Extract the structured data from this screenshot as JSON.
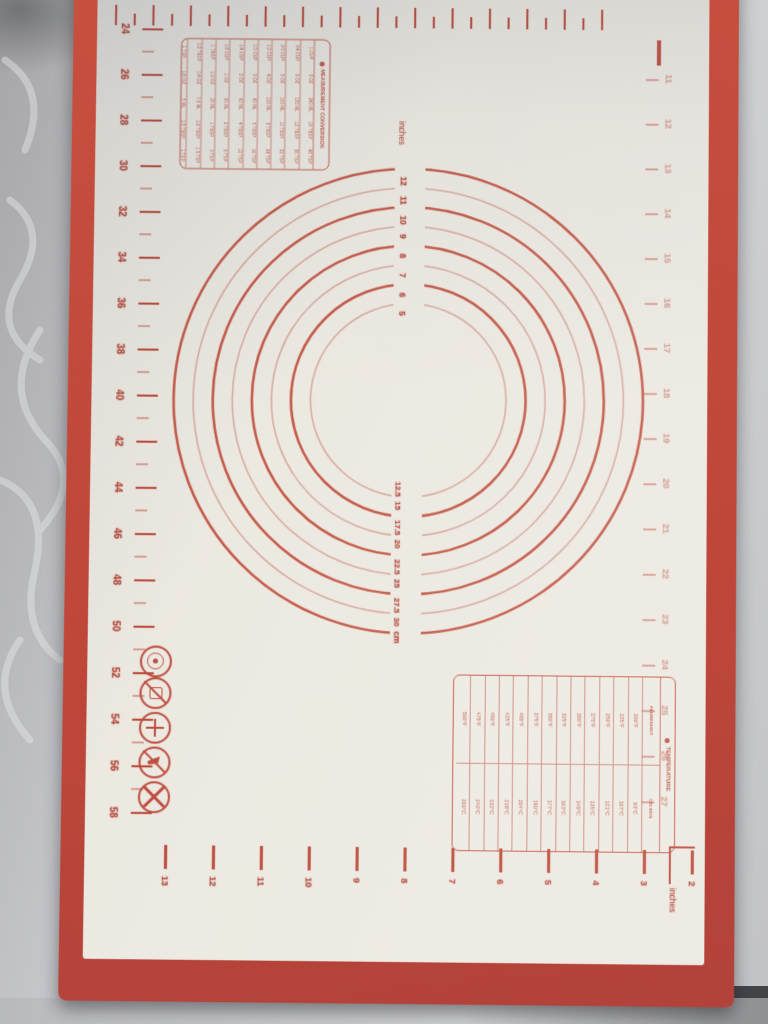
{
  "mat": {
    "colors": {
      "mat_red": "#bf4739",
      "print_red": "#b44a3c",
      "faint_arc": "#cf9186",
      "surface_cream": "#ece9e1",
      "fabric_gray": "#c6c7cb"
    },
    "circles": {
      "unit_top_label": "inches",
      "unit_bottom_label": "cm",
      "inch_labels": [
        "12",
        "11",
        "10",
        "9",
        "8",
        "7",
        "6",
        "5"
      ],
      "cm_labels": [
        "12.5",
        "15",
        "17.5",
        "20",
        "22.5",
        "25",
        "27.5",
        "30"
      ],
      "diameters_inches": [
        12,
        11,
        10,
        9,
        8,
        7,
        6,
        5
      ]
    },
    "left_ruler": {
      "unit": "cm",
      "labels": [
        "24",
        "26",
        "28",
        "30",
        "32",
        "34",
        "36",
        "38",
        "40",
        "42",
        "44",
        "46",
        "48",
        "50",
        "52",
        "54",
        "56",
        "58"
      ]
    },
    "bottom_ruler": {
      "unit_label": "inches",
      "labels": [
        "13",
        "12",
        "11",
        "10",
        "9",
        "8",
        "7",
        "6",
        "5",
        "4",
        "3",
        "2"
      ]
    },
    "right_ruler": {
      "unit": "inches",
      "labels": [
        "11",
        "12",
        "13",
        "14",
        "15",
        "16",
        "17",
        "18",
        "19",
        "20",
        "21",
        "22",
        "23",
        "24",
        "25",
        "26",
        "27"
      ]
    },
    "measurement_table": {
      "title": "MEASUREMENT CONVERSION",
      "rows": [
        [
          "1 CUP",
          "8 OZ",
          "240 ML",
          "16 TBSP",
          "48 TSP"
        ],
        [
          "3/4 CUP",
          "6 OZ",
          "180 ML",
          "12 TBSP",
          "36 TSP"
        ],
        [
          "2/3 CUP",
          "5 OZ",
          "160 ML",
          "11 TBSP",
          "32 TSP"
        ],
        [
          "1/2 CUP",
          "4 OZ",
          "120 ML",
          "8 TBSP",
          "24 TSP"
        ],
        [
          "1/3 CUP",
          "3 OZ",
          "80 ML",
          "5 TBSP",
          "16 TSP"
        ],
        [
          "1/4 CUP",
          "2 OZ",
          "60 ML",
          "4 TBSP",
          "12 TSP"
        ],
        [
          "1/8 CUP",
          "1 OZ",
          "30 ML",
          "2 TBSP",
          "6 TSP"
        ],
        [
          "1 TBSP",
          "1/2 OZ",
          "15 ML",
          "1 TBSP",
          "3 TSP"
        ],
        [
          "1/2 TBSP",
          "1/4 OZ",
          "7.5 ML",
          "1/2 TBSP",
          "1.5 TSP"
        ],
        [
          "1 TSP",
          "1/6 OZ",
          "5 ML",
          "1/3 TBSP",
          "1 TSP"
        ]
      ]
    },
    "temperature_table": {
      "title": "TEMPERATURE",
      "col_fahrenheit": "FAHRENHEIT",
      "col_celsius": "CELSIUS",
      "fahrenheit": [
        "200°F",
        "225°F",
        "250°F",
        "275°F",
        "300°F",
        "325°F",
        "350°F",
        "375°F",
        "400°F",
        "425°F",
        "450°F",
        "475°F",
        "500°F"
      ],
      "celsius": [
        "93°C",
        "107°C",
        "121°C",
        "135°C",
        "149°C",
        "163°C",
        "177°C",
        "190°C",
        "204°C",
        "218°C",
        "232°C",
        "246°C",
        "260°C"
      ]
    },
    "icons": [
      "badge-icon",
      "no-bakeware-icon",
      "whisk-icon",
      "no-knife-icon",
      "prohibition-x-icon"
    ]
  }
}
